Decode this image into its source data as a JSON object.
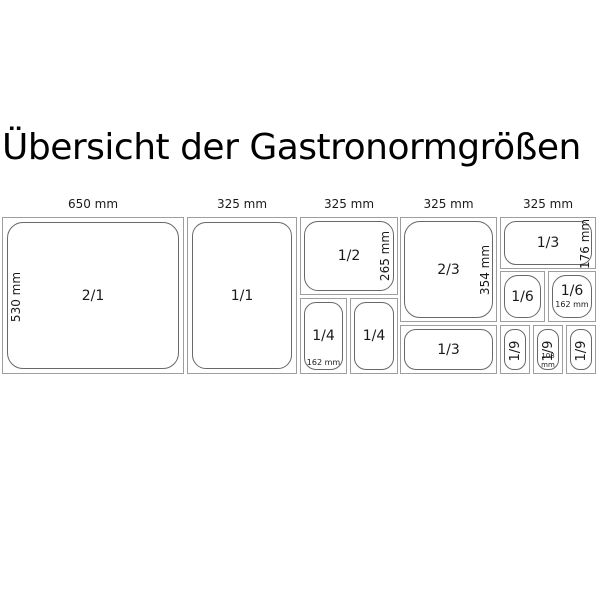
{
  "title": "Übersicht der Gastronormgrößen",
  "colors": {
    "background": "#ffffff",
    "cell_border": "#9e9e9e",
    "pan_border": "#686868",
    "text": "#1a1a1a"
  },
  "columns": [
    {
      "width_label": "650 mm"
    },
    {
      "width_label": "325 mm"
    },
    {
      "width_label": "325 mm"
    },
    {
      "width_label": "325 mm"
    },
    {
      "width_label": "325 mm"
    }
  ],
  "cells": {
    "gn21": {
      "label": "2/1",
      "height_label": "530 mm"
    },
    "gn11": {
      "label": "1/1"
    },
    "gn12": {
      "label": "1/2",
      "height_label": "265 mm"
    },
    "gn14a": {
      "label": "1/4",
      "depth_label": "162 mm"
    },
    "gn14b": {
      "label": "1/4"
    },
    "gn23": {
      "label": "2/3",
      "height_label": "354 mm"
    },
    "gn13a": {
      "label": "1/3"
    },
    "gn13b": {
      "label": "1/3",
      "height_label": "176 mm"
    },
    "gn16a": {
      "label": "1/6"
    },
    "gn16b": {
      "label": "1/6",
      "depth_label": "162 mm"
    },
    "gn19a": {
      "label": "1/9"
    },
    "gn19b": {
      "label": "1/9",
      "depth_label": "108 mm"
    },
    "gn19c": {
      "label": "1/9"
    }
  }
}
